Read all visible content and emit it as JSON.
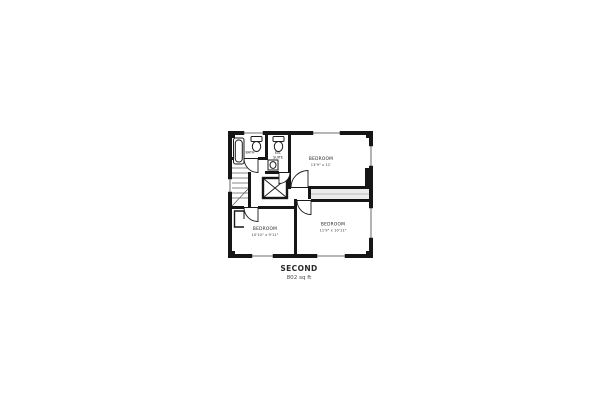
{
  "floorplan": {
    "floor_label": "SECOND",
    "floor_area": "802 sq ft",
    "rooms": {
      "bath": {
        "label": "BATH"
      },
      "ensuite": {
        "line1": "EN-",
        "line2": "SUITE"
      },
      "bedroom_top": {
        "label": "BEDROOM",
        "dims": "13'9\" x 11'"
      },
      "bedroom_left": {
        "label": "BEDROOM",
        "dims": "10'10\" x 9'11\""
      },
      "bedroom_right": {
        "label": "BEDROOM",
        "dims": "11'9\" x 10'11\""
      }
    },
    "colors": {
      "wall": "#161616",
      "window": "#8a8a8a",
      "background": "#ffffff",
      "text": "#1c1c1c"
    }
  }
}
